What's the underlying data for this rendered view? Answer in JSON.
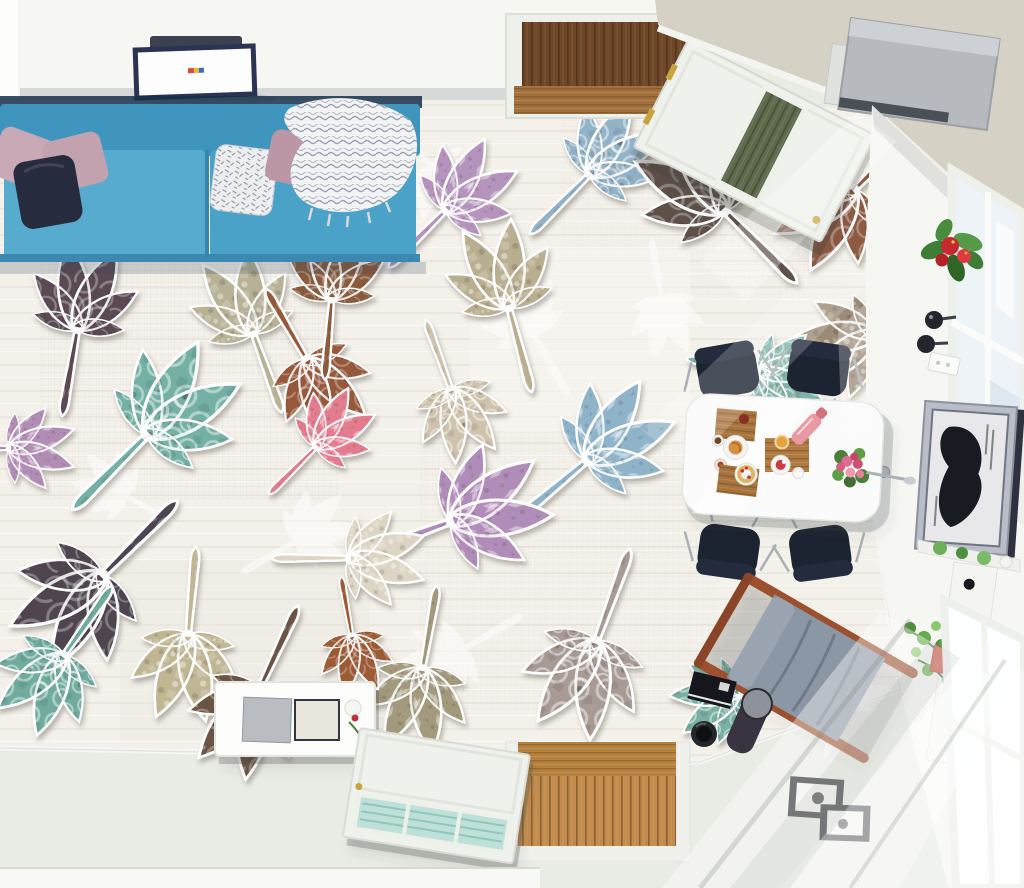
{
  "meta": {
    "title": "Top-down living room render with chestnut-leaf patchwork floor mural",
    "view": "bird's-eye"
  },
  "colors": {
    "wall": "#f6f6f3",
    "ceiling": "#d6d1c5",
    "floor_plain": "#e9ebe5",
    "floor_mural": "#f3f1ea",
    "baseboard": "#f8f9f7",
    "sofa": "#4aa2c8",
    "sofa_seat": "#57abce",
    "sofa_back": "#3f95bd",
    "sofa_shadow": "#16304a",
    "pillow_mauve": "#c3a2af",
    "pillow_navy": "#272b3e",
    "pillow_white": "#eceef0",
    "throw_white": "#f2f3f5",
    "light_frame": "#2b3352",
    "light_panel": "#fdfdfd",
    "door_white": "#eff1ec",
    "door_glass_top": "#5f6b4f",
    "door_glass_bottom": "#bfe0d8",
    "wood_dark": "#6d4728",
    "wood_threshold": "#a1713e",
    "wood_oak": "#c28c4d",
    "projector": "#b6b9bd",
    "bracket": "#e0e2df",
    "table": "#fafbfa",
    "chair": "#1c2331",
    "chrome": "#a9b0b6",
    "board_wood": "#a8743d",
    "console": "#fdfdfc",
    "console_gray": "#b9bcc0",
    "console_cream": "#e9e7dc",
    "lounge_fabric": "#8b97a4",
    "lounge_wood": "#9c5030",
    "frame_black": "#1a1d22",
    "art_frame": "#b9bdc7",
    "art_dark": "#191b22",
    "plant_green": "#4e8f3d",
    "flower_red": "#c62a2e",
    "rose_pink": "#df6c8c",
    "pot_red": "#cc4a3c",
    "glass": "#eef3f8",
    "sconce": "#23262c"
  },
  "mural": {
    "silhouettes": [
      {
        "name": "leaf-silhouette",
        "x": 432,
        "y": 168,
        "rot": 140,
        "scale": 0.95,
        "color": "#ffffff",
        "opacity": 0.5
      },
      {
        "name": "leaf-silhouette",
        "x": 532,
        "y": 332,
        "rot": -30,
        "scale": 1.0,
        "color": "#ffffff",
        "opacity": 0.5
      },
      {
        "name": "leaf-silhouette",
        "x": 298,
        "y": 540,
        "rot": 60,
        "scale": 0.9,
        "color": "#ffffff",
        "opacity": 0.5
      },
      {
        "name": "leaf-silhouette",
        "x": 662,
        "y": 300,
        "rot": 170,
        "scale": 0.85,
        "color": "#ffffff",
        "opacity": 0.5
      },
      {
        "name": "leaf-silhouette",
        "x": 462,
        "y": 650,
        "rot": -120,
        "scale": 0.95,
        "color": "#ffffff",
        "opacity": 0.5
      },
      {
        "name": "leaf-silhouette",
        "x": 845,
        "y": 702,
        "rot": 20,
        "scale": 0.8,
        "color": "#ffffff",
        "opacity": 0.5
      },
      {
        "name": "leaf-silhouette",
        "x": 125,
        "y": 495,
        "rot": -60,
        "scale": 0.8,
        "color": "#ffffff",
        "opacity": 0.5
      },
      {
        "name": "leaf-silhouette",
        "x": 735,
        "y": 152,
        "rot": 80,
        "scale": 0.8,
        "color": "#ffffff",
        "opacity": 0.5
      }
    ],
    "leaves": [
      {
        "name": "leaf-teal",
        "x": 150,
        "y": 432,
        "rot": 45,
        "scale": 1.5,
        "color": "#74b0a4",
        "pattern": "p-moroccan"
      },
      {
        "name": "leaf-plum",
        "x": 78,
        "y": 326,
        "rot": 10,
        "scale": 1.25,
        "color": "#5a4a52",
        "pattern": "p-swirl"
      },
      {
        "name": "leaf-sage",
        "x": 252,
        "y": 330,
        "rot": -20,
        "scale": 1.2,
        "color": "#b7b196",
        "pattern": "p-tile"
      },
      {
        "name": "leaf-rust",
        "x": 308,
        "y": 362,
        "rot": 150,
        "scale": 1.15,
        "color": "#96583a",
        "pattern": "p-swirl"
      },
      {
        "name": "leaf-lavender",
        "x": 448,
        "y": 208,
        "rot": 45,
        "scale": 1.15,
        "color": "#b493bd",
        "pattern": "p-damask"
      },
      {
        "name": "leaf-bluegray",
        "x": 592,
        "y": 172,
        "rot": 45,
        "scale": 1.2,
        "color": "#92b2c8",
        "pattern": "p-moroccan"
      },
      {
        "name": "leaf-charcoal",
        "x": 722,
        "y": 208,
        "rot": -45,
        "scale": 1.45,
        "color": "#5e5049",
        "pattern": "p-swirl"
      },
      {
        "name": "leaf-rust-2",
        "x": 852,
        "y": 192,
        "rot": 225,
        "scale": 1.3,
        "color": "#8d5a42",
        "pattern": "p-swirl"
      },
      {
        "name": "leaf-cream",
        "x": 452,
        "y": 392,
        "rot": 160,
        "scale": 1.05,
        "color": "#cfc3ad",
        "pattern": "p-moroccan"
      },
      {
        "name": "leaf-blue-2",
        "x": 590,
        "y": 458,
        "rot": 50,
        "scale": 1.35,
        "color": "#8fb3c9",
        "pattern": "p-damask"
      },
      {
        "name": "leaf-violet",
        "x": 455,
        "y": 520,
        "rot": 70,
        "scale": 1.45,
        "color": "#b08cb8",
        "pattern": "p-damask"
      },
      {
        "name": "leaf-pink",
        "x": 318,
        "y": 445,
        "rot": 45,
        "scale": 0.95,
        "color": "#e27c8e",
        "pattern": "p-damask"
      },
      {
        "name": "leaf-plum-dark",
        "x": 100,
        "y": 578,
        "rot": 225,
        "scale": 1.5,
        "color": "#4f4550",
        "pattern": "p-swirl"
      },
      {
        "name": "leaf-teal-2",
        "x": 62,
        "y": 658,
        "rot": 215,
        "scale": 1.2,
        "color": "#6fab9e",
        "pattern": "p-moroccan"
      },
      {
        "name": "leaf-beige",
        "x": 188,
        "y": 638,
        "rot": 185,
        "scale": 1.25,
        "color": "#c0b694",
        "pattern": "p-tile"
      },
      {
        "name": "leaf-chocolate",
        "x": 258,
        "y": 692,
        "rot": 205,
        "scale": 1.3,
        "color": "#6b5544",
        "pattern": "p-swirl"
      },
      {
        "name": "leaf-khaki",
        "x": 422,
        "y": 672,
        "rot": 190,
        "scale": 1.2,
        "color": "#a39a7e",
        "pattern": "p-damask"
      },
      {
        "name": "leaf-mosaic",
        "x": 595,
        "y": 645,
        "rot": 200,
        "scale": 1.4,
        "color": "#a89a94",
        "pattern": "p-moroccan"
      },
      {
        "name": "leaf-brown-top",
        "x": 332,
        "y": 296,
        "rot": 5,
        "scale": 1.15,
        "color": "#8a5a3c",
        "pattern": "p-swirl"
      },
      {
        "name": "leaf-taupe",
        "x": 872,
        "y": 335,
        "rot": 250,
        "scale": 1.2,
        "color": "#9b8a74",
        "pattern": "p-tile"
      },
      {
        "name": "leaf-teal-3",
        "x": 762,
        "y": 372,
        "rot": 100,
        "scale": 1.05,
        "color": "#7fb3a6",
        "pattern": "p-moroccan"
      },
      {
        "name": "leaf-ivory",
        "x": 352,
        "y": 558,
        "rot": 90,
        "scale": 1.1,
        "color": "#ddd5c4",
        "pattern": "p-tile"
      },
      {
        "name": "leaf-lavender-edge",
        "x": 12,
        "y": 448,
        "rot": 90,
        "scale": 0.95,
        "color": "#b18cb4",
        "pattern": "p-damask"
      },
      {
        "name": "leaf-rust-3",
        "x": 352,
        "y": 638,
        "rot": 170,
        "scale": 0.85,
        "color": "#9c5a36",
        "pattern": "p-swirl"
      },
      {
        "name": "leaf-teal-4",
        "x": 737,
        "y": 692,
        "rot": 250,
        "scale": 1.0,
        "color": "#79b0a3",
        "pattern": "p-moroccan"
      },
      {
        "name": "leaf-sage-2",
        "x": 508,
        "y": 304,
        "rot": -15,
        "scale": 1.25,
        "color": "#b9ae8f",
        "pattern": "p-tile"
      }
    ]
  },
  "objects": [
    "blue-fabric-sofa",
    "mauve-pillows",
    "navy-pillow",
    "white-knit-throw",
    "ceiling-light-panel",
    "top-doorway-dark-wood",
    "open-white-door-top",
    "ceiling-projector",
    "beige-ceiling",
    "window-wall",
    "red-anthurium-plant",
    "wall-sconces",
    "framed-horse-artwork",
    "door-handle",
    "dining-table",
    "black-dining-chairs",
    "breakfast-boards",
    "rose-bouquet",
    "white-media-console",
    "open-white-door-bottom",
    "bottom-doorway-oak-floor",
    "lounge-chair",
    "black-photo-frames",
    "ivy-plant",
    "red-wall-pots",
    "radiator-panel"
  ]
}
